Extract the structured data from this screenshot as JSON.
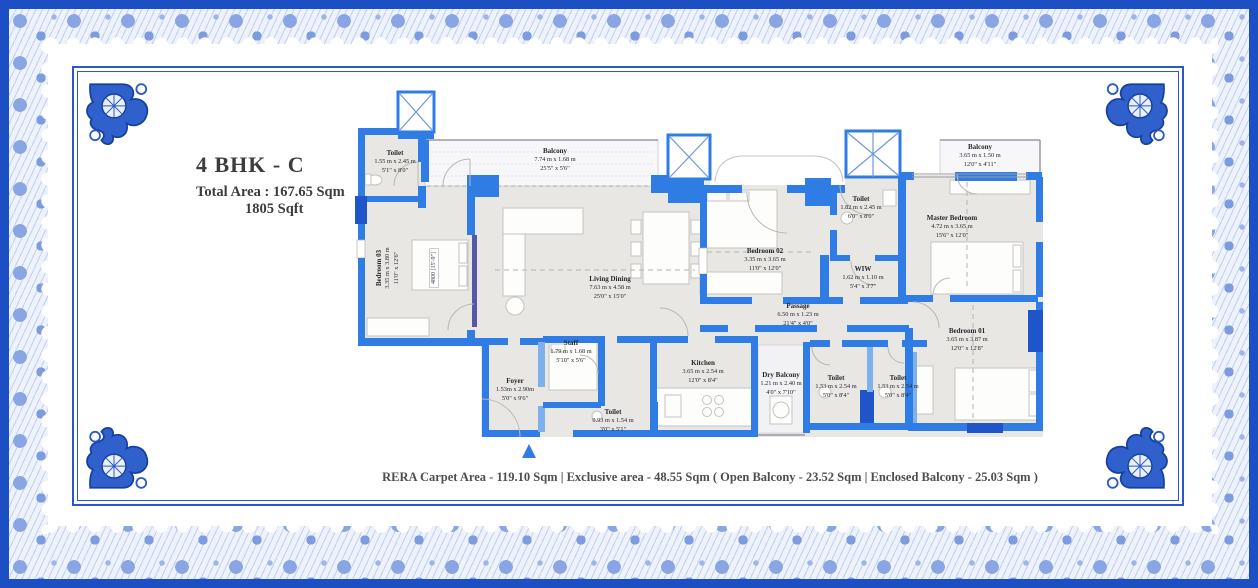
{
  "colors": {
    "border_blue": "#1d4fc4",
    "floral_blue": "#8aa5e3",
    "wall_blue": "#2f7de4",
    "wall_dark": "#1f55c9",
    "wall_light": "#7fb0ee",
    "slider_purple": "#5b55a8",
    "floor_gray": "#e9e7e3"
  },
  "title": {
    "name": "4 BHK - C",
    "area_label": "Total Area : ",
    "area_sqm": "167.65 Sqm",
    "area_sqft": "1805 Sqft"
  },
  "plan": {
    "rooms": [
      {
        "id": "toilet-top-left",
        "name": "Toilet",
        "dims_m": "1.55 m x 2.45 m",
        "dims_ft": "5'1\" x 8'0\""
      },
      {
        "id": "balcony-top",
        "name": "Balcony",
        "dims_m": "7.74 m x 1.68 m",
        "dims_ft": "25'5\" x 5'6\""
      },
      {
        "id": "balcony-top-right",
        "name": "Balcony",
        "dims_m": "3.65 m x 1.50 m",
        "dims_ft": "12'0\" x 4'11\""
      },
      {
        "id": "toilet-master",
        "name": "Toilet",
        "dims_m": "1.82 m x 2.45 m",
        "dims_ft": "6'0\" x 8'0\""
      },
      {
        "id": "master-bedroom",
        "name": "Master Bedroom",
        "dims_m": "4.72 m x 3.65 m",
        "dims_ft": "15'6\" x 12'0\""
      },
      {
        "id": "bedroom-03",
        "name": "Bedroom 03",
        "dims_m": "3.35 m x 3.80 m",
        "dims_ft": "11'0\" x 12'6\""
      },
      {
        "id": "living-dining",
        "name": "Living  Dining",
        "dims_m": "7.63 m x 4.58 m",
        "dims_ft": "25'0\" x 15'0\""
      },
      {
        "id": "bedroom-02",
        "name": "Bedroom 02",
        "dims_m": "3.35 m x 3.65 m",
        "dims_ft": "11'0\" x 12'0\""
      },
      {
        "id": "wiw",
        "name": "WIW",
        "dims_m": "1.62 m x 1.10 m",
        "dims_ft": "5'4\" x 3'7\""
      },
      {
        "id": "passage",
        "name": "Passage",
        "dims_m": "6.50 m x 1.23 m",
        "dims_ft": "21'4\" x 4'0\""
      },
      {
        "id": "bedroom-01",
        "name": "Bedroom 01",
        "dims_m": "3.65 m x 3.87 m",
        "dims_ft": "12'0\" x 12'8\""
      },
      {
        "id": "staff",
        "name": "Staff",
        "dims_m": "1.79 m x 1.68 m",
        "dims_ft": "5'10\" x 5'6\""
      },
      {
        "id": "kitchen",
        "name": "Kitchen",
        "dims_m": "3.65 m x 2.54 m",
        "dims_ft": "12'0\" x 8'4\""
      },
      {
        "id": "dry-balcony",
        "name": "Dry Balcony",
        "dims_m": "1.21 m x 2.40 m",
        "dims_ft": "4'0\" x 7'10\""
      },
      {
        "id": "toilet-bottom-1",
        "name": "Toilet",
        "dims_m": "1.53 m x 2.54 m",
        "dims_ft": "5'0\" x 8'4\""
      },
      {
        "id": "toilet-bottom-2",
        "name": "Toilet",
        "dims_m": "1.53 m x 2.54 m",
        "dims_ft": "5'0\" x 8'4\""
      },
      {
        "id": "foyer",
        "name": "Foyer",
        "dims_m": "1.53m x 2.90m",
        "dims_ft": "5'0\" x 9'6\""
      },
      {
        "id": "toilet-small",
        "name": "Toilet",
        "dims_m": "0.93 m x 1.54 m",
        "dims_ft": "3'0\" x 5'1\""
      }
    ],
    "dimension_label": "4800 [15'-9\"]"
  },
  "footer": {
    "text": "RERA Carpet Area - 119.10 Sqm | Exclusive area - 48.55 Sqm ( Open Balcony - 23.52 Sqm | Enclosed Balcony - 25.03 Sqm )"
  }
}
